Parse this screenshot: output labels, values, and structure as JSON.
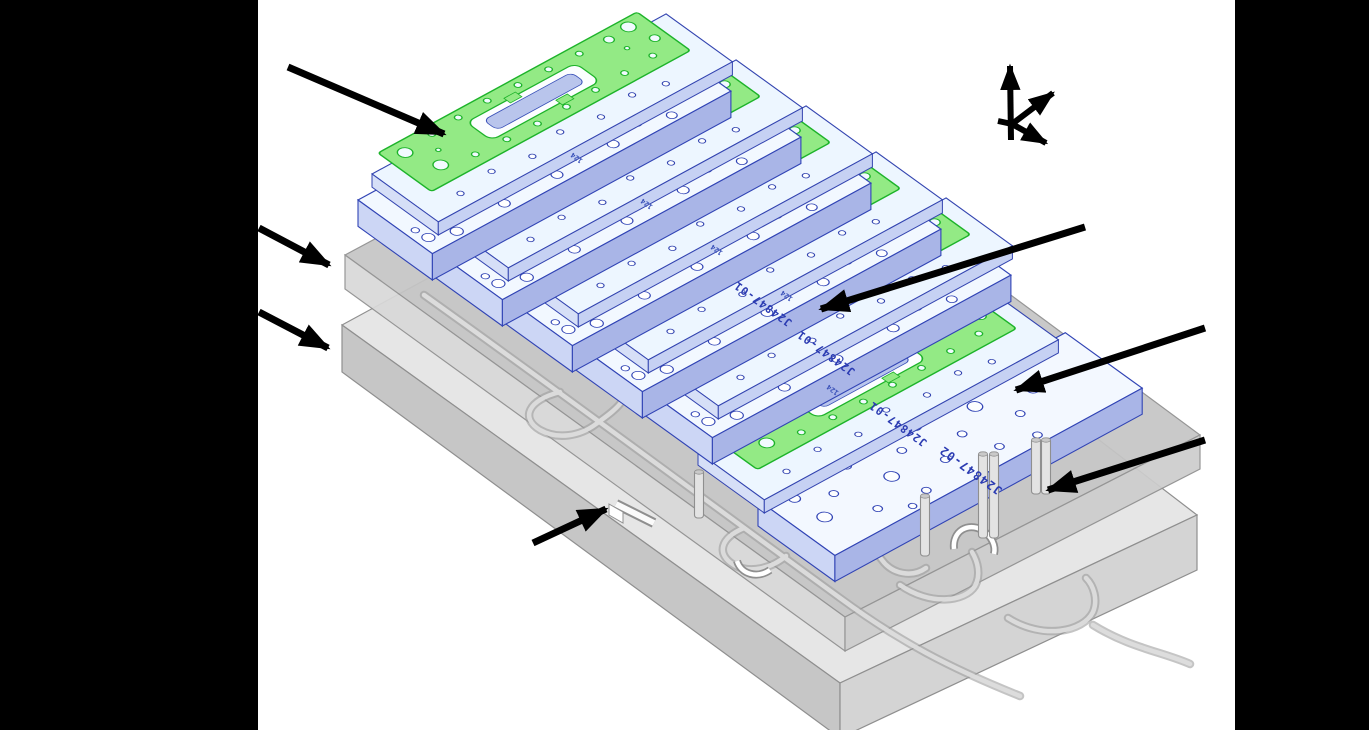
{
  "figure": {
    "type": "cad-exploded-assembly-isometric",
    "background": "#ffffff",
    "mask_bar_color": "#000000",
    "parts": {
      "green_cover_plate": {
        "count": 6,
        "fill": "#93ea85",
        "outline": "#1db32a"
      },
      "thin_plate": {
        "part_number": "J24847-01",
        "labeled_instances": 3,
        "fill": "#edf6ff",
        "outline": "#3144b5"
      },
      "thick_plate": {
        "part_number": "J24847-02",
        "labeled_instances": 1,
        "fill": "#f3f8ff",
        "outline": "#3144b5"
      },
      "upper_base_slab": {
        "fill": "#c5c5c5",
        "outline": "#8f8f8f"
      },
      "lower_base_slab": {
        "fill": "#e6e6e6",
        "outline": "#8f8f8f"
      },
      "cutout_marking": "124",
      "label_color": "#2b3bb2"
    },
    "annotations": {
      "callout_arrow_count": 7,
      "axis_triad_arrow_count": 3,
      "arrow_color": "#000000"
    }
  }
}
